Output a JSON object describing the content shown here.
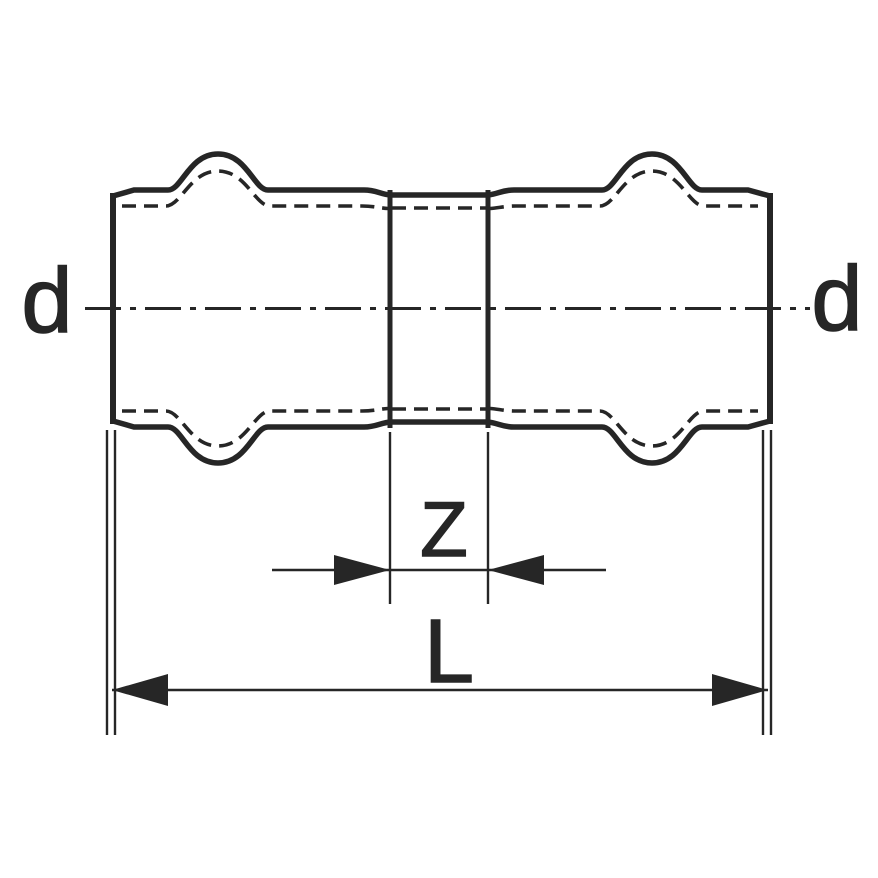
{
  "diagram": {
    "colors": {
      "line": "#262626",
      "background": "#ffffff"
    },
    "labels": {
      "diameter_left": "d",
      "diameter_right": "d",
      "dim_z": "Z",
      "dim_l": "L"
    }
  }
}
